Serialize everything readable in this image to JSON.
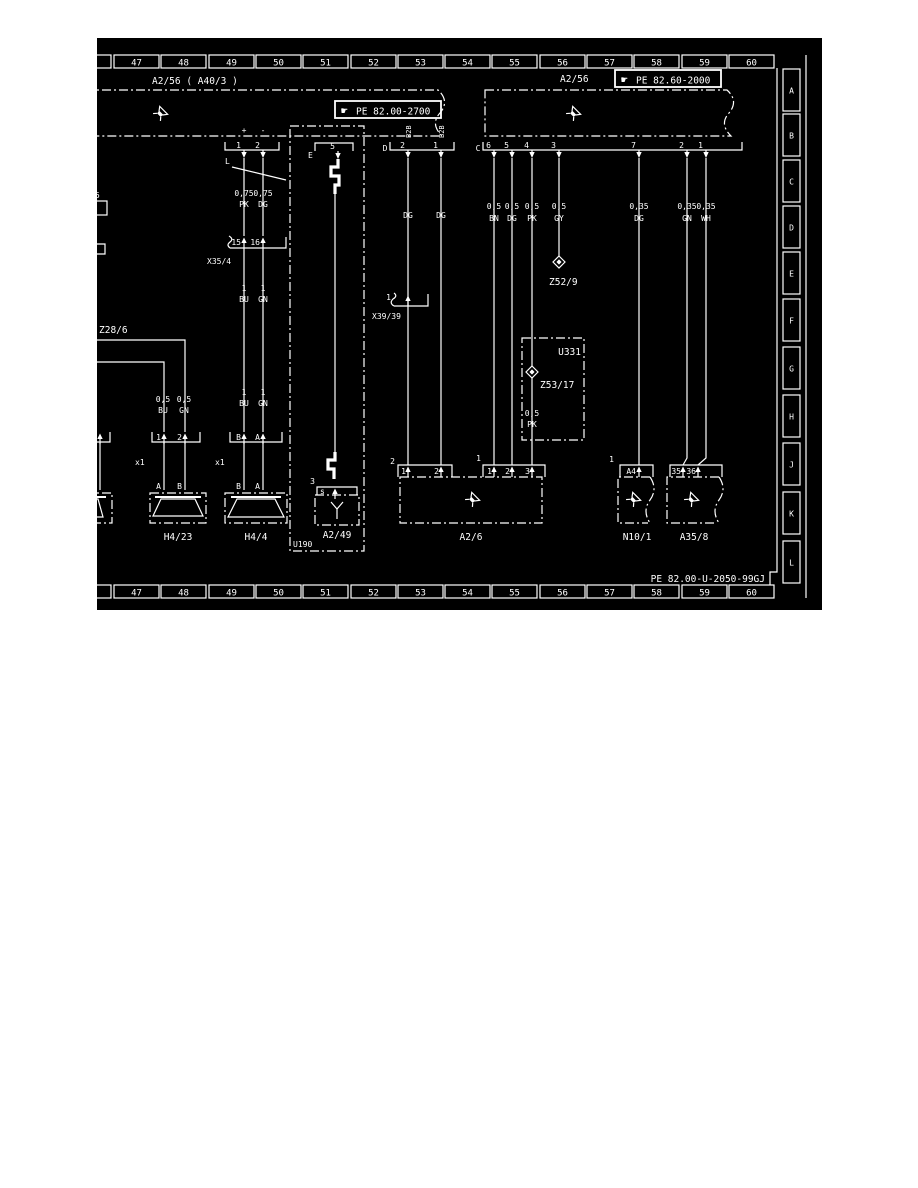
{
  "doc": {
    "number": "PE 82.00-U-2050-99GJ"
  },
  "ruler_cols": [
    "47",
    "48",
    "49",
    "50",
    "51",
    "52",
    "53",
    "54",
    "55",
    "56",
    "57",
    "58",
    "59",
    "60"
  ],
  "row_letters": [
    "A",
    "B",
    "C",
    "D",
    "E",
    "F",
    "G",
    "H",
    "J",
    "K",
    "L"
  ],
  "icons": {
    "hand": "☛"
  },
  "units": {
    "left": {
      "label": "A2/56 ( A40/3 )",
      "ref": "PE 82.00-2700"
    },
    "right": {
      "label": "A2/56",
      "ref": "PE 82.60-2000"
    }
  },
  "connectors": {
    "radio": {
      "plus": "+",
      "minus": "-",
      "p1": "1",
      "p2": "2",
      "note": "L"
    },
    "d": {
      "label": "D",
      "p2": "2",
      "p1": "1",
      "code2": "B2B",
      "code1": "B2B"
    },
    "e": {
      "label": "E",
      "pin": "5"
    },
    "c": {
      "label": "C",
      "pins": [
        "6",
        "5",
        "4",
        "3",
        "7",
        "2",
        "1"
      ]
    },
    "x35_4": {
      "label": "X35/4",
      "p15": "15",
      "p16": "16"
    },
    "x39_39": {
      "label": "X39/39",
      "p1": "1"
    },
    "x1_left": {
      "label": "x1",
      "p1": "1",
      "p2": "2"
    },
    "x1_right": {
      "label": "x1",
      "pb": "B",
      "pa": "A"
    },
    "coax": {
      "num": "3",
      "pin": "s"
    },
    "a2_6_left": {
      "label": "2",
      "p1": "1",
      "p2": "2"
    },
    "a2_6_right": {
      "label": "1",
      "p1": "1",
      "p2": "2",
      "p3": "3"
    },
    "n10_1": {
      "label": "1",
      "pin": "A4"
    },
    "a35_8": {
      "p35": "35",
      "p36": "36"
    }
  },
  "wires": {
    "w075pk": {
      "size": "0,75",
      "color": "PK"
    },
    "w075dg": {
      "size": "0,75",
      "color": "DG"
    },
    "w1bu_a": {
      "size": "1",
      "color": "BU"
    },
    "w1gn_a": {
      "size": "1",
      "color": "GN"
    },
    "w1bu_b": {
      "size": "1",
      "color": "BU"
    },
    "w1gn_b": {
      "size": "1",
      "color": "GN"
    },
    "w05bu": {
      "size": "0,5",
      "color": "BU"
    },
    "w05gn": {
      "size": "0,5",
      "color": "GN"
    },
    "wdg_a": {
      "color": "DG"
    },
    "wdg_b": {
      "color": "DG"
    },
    "w05bn": {
      "size": "0,5",
      "color": "BN"
    },
    "w05dg": {
      "size": "0,5",
      "color": "DG"
    },
    "w05pk": {
      "size": "0,5",
      "color": "PK"
    },
    "w05gy": {
      "size": "0,5",
      "color": "GY"
    },
    "w035dg": {
      "size": "0,35",
      "color": "DG"
    },
    "w035gn": {
      "size": "0,35",
      "color": "GN"
    },
    "w035wh": {
      "size": "0,35",
      "color": "WH"
    },
    "w05pk_u331": {
      "size": "0,5",
      "color": "PK"
    }
  },
  "devices": {
    "z28_6": "Z28/6",
    "h4_23": "H4/23",
    "h4_4": "H4/4",
    "u190": "U190",
    "a2_49": "A2/49",
    "z52_9": "Z52/9",
    "u331": "U331",
    "z53_17": "Z53/17",
    "a2_6": "A2/6",
    "n10_1": "N10/1",
    "a35_8": "A35/8"
  },
  "speaker_pins": {
    "h423_a": "A",
    "h423_b": "B",
    "h44_b": "B",
    "h44_a": "A"
  },
  "frag": {
    "five": "5"
  }
}
